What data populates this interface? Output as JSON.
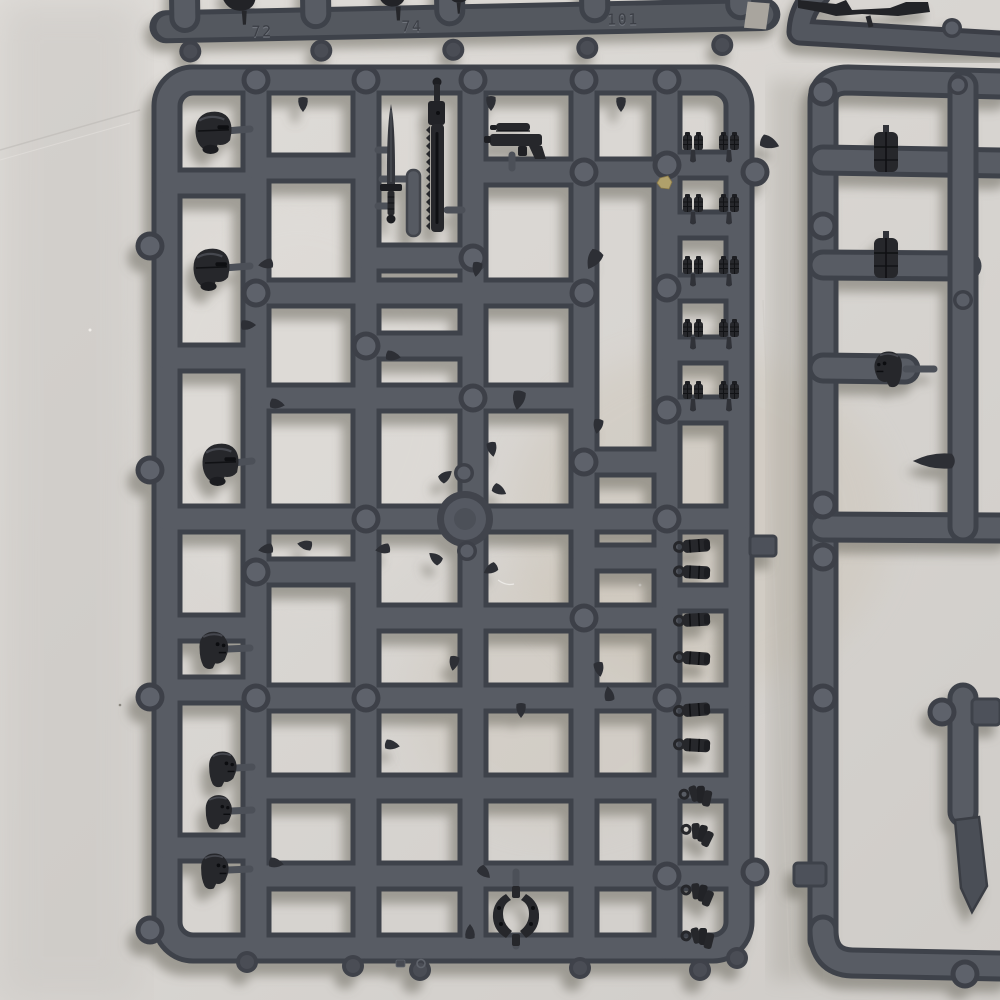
{
  "scene": {
    "description": "Overhead photo of dark grey plastic miniature model kit sprues laid on off-white paper",
    "lighting": "soft daylight from upper right, shadows fall down-left"
  },
  "colors": {
    "paper": "#d8d5d1",
    "paper_warm_patch": "#c9bfae",
    "plastic_face": "#585c64",
    "plastic_edge": "#3e424a",
    "part_dark": "#26272b",
    "cast_shadow": "#7a766e",
    "debris_gold": "#b0a06b"
  },
  "sprues": {
    "top_strip": {
      "label": "top sprue fragment with embossed part numbers",
      "numbers": [
        "72",
        "74",
        "101"
      ],
      "dangling_parts": 3,
      "pegs": 5
    },
    "top_right": {
      "label": "top-right sprue fragment",
      "dark_parts": 1
    },
    "main": {
      "label": "main sprue grid",
      "columns": 6,
      "parts": {
        "helmeted_heads": 3,
        "bare_heads": 4,
        "power_sword": 1,
        "chainsword": 1,
        "scoped_pistol": 1,
        "grenade_pairs": 10,
        "belt_pouches": 6,
        "grenade_bundles": 4,
        "bracket_yoke": 1,
        "flat_strip": 1,
        "round_disc": 1
      },
      "debris": "small gold chip",
      "mold_marks": 2
    },
    "right_partial": {
      "label": "right sprue fragment",
      "parts": {
        "vertical_pouches": 2,
        "head": 1,
        "blades": 2
      }
    }
  }
}
